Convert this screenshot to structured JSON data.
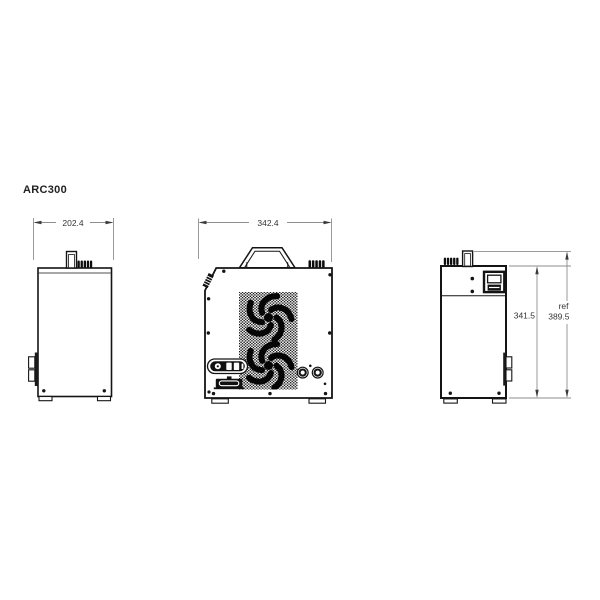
{
  "title": "ARC300",
  "colors": {
    "background": "#ffffff",
    "outline": "#141414",
    "dimension_lines": "#8e8e8e",
    "dimension_text": "#333333"
  },
  "views": {
    "side_left": {
      "width_dim": "202.4"
    },
    "front": {
      "width_dim": "342.4"
    },
    "side_right": {
      "height_dim": "341.5",
      "ref_label": "ref",
      "ref_height_dim": "389.5"
    }
  }
}
